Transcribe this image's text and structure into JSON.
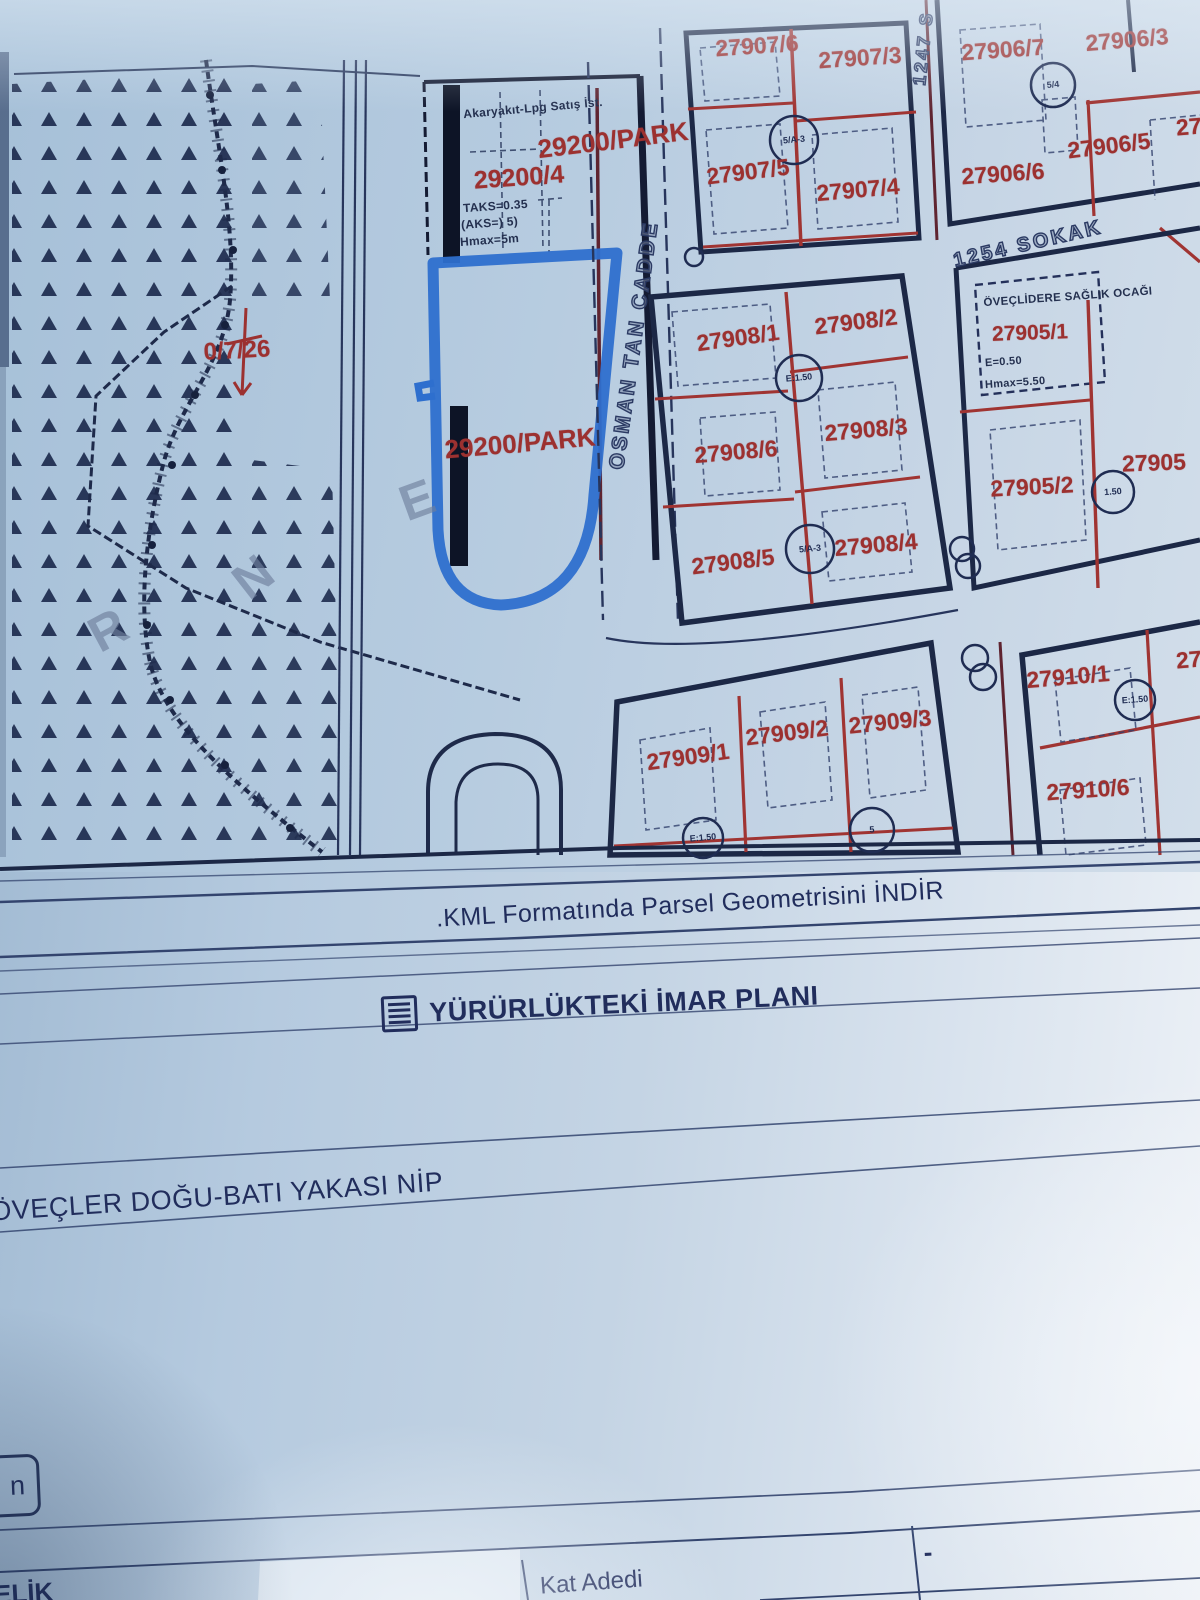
{
  "map": {
    "parcels": {
      "p27907_6": "27907/6",
      "p27907_3": "27907/3",
      "p27907_5": "27907/5",
      "p27907_4": "27907/4",
      "p27906_7": "27906/7",
      "p27906_3": "27906/3",
      "p27906_5": "27906/5",
      "p27906_6": "27906/6",
      "p27906_cut": "27",
      "p27908_1": "27908/1",
      "p27908_2": "27908/2",
      "p27908_3": "27908/3",
      "p27908_4": "27908/4",
      "p27908_5": "27908/5",
      "p27908_6": "27908/6",
      "p27905_1": "27905/1",
      "p27905_2": "27905/2",
      "p27905_cut": "27905",
      "p27909_1": "27909/1",
      "p27909_2": "27909/2",
      "p27909_3": "27909/3",
      "p27910_1": "27910/1",
      "p27910_6": "27910/6",
      "p27910_cut": "27",
      "park_upper": "29200/PARK",
      "park_lower": "29200/PARK",
      "p29200_4": "29200/4",
      "red_note": "0/7/26"
    },
    "streets": {
      "osman_tan": "OSMAN TAN CADDE",
      "s1254": "1254 SOKAK",
      "s1247": "1247 S"
    },
    "annotations": {
      "akaryakit": "Akaryakıt-Lpg Satış İst.",
      "taks_line1": "TAKS=0.35",
      "taks_line2": "(AKS=) 5)",
      "taks_line3": "Hmax=5m",
      "saglik": "ÖVEÇLİDERE SAĞLIK OCAĞI",
      "e_value": "E=0.50",
      "hmax_value": "Hmax=5.50"
    },
    "markers": {
      "mk1": "5/A-3",
      "mk2": "5/4",
      "mk3": "E:1.50",
      "mk4": "5/A-3",
      "mk5": "1.50",
      "mk6": "E:1.50",
      "mk7": "E:1.50",
      "mk8": "5"
    },
    "watermarks": {
      "e": "E",
      "n": "N",
      "r": "R"
    }
  },
  "document": {
    "kml_link": ".KML Formatında Parsel Geometrisini İNDİR",
    "plan_section": "YÜRÜRLÜKTEKİ İMAR PLANI",
    "nip_title": "ÖVEÇLER DOĞU-BATI YAKASI NİP",
    "button_n": "n",
    "corner_text": "ELİK",
    "fields": {
      "kat_adedi_label": "Kat Adedi",
      "kat_adedi_value": "-"
    }
  },
  "colors": {
    "parcel_number_red": "#9c3130",
    "line_navy": "#27355c",
    "highlight_blue": "#2e6fce",
    "paper_blue": "#b7cce0"
  }
}
